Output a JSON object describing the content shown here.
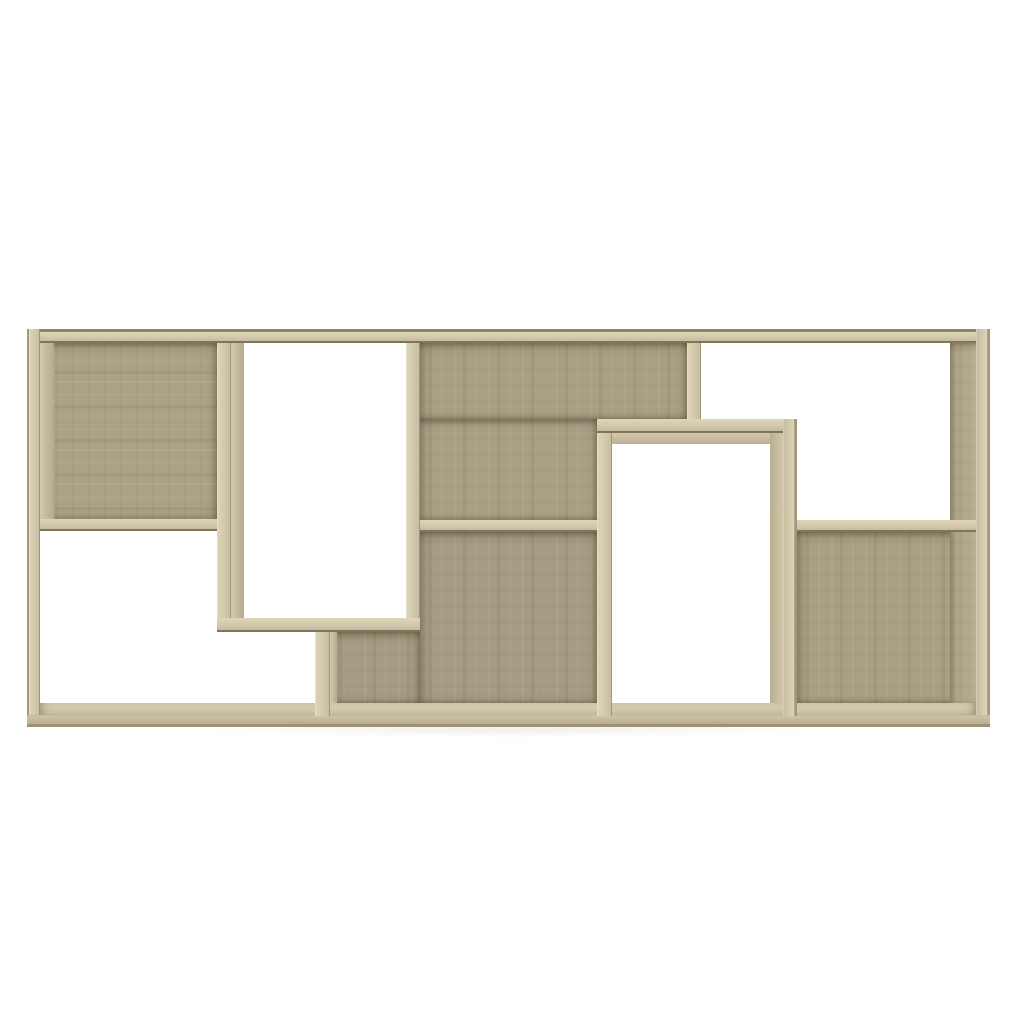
{
  "meta": {
    "description": "Product photo of a geometric cube wall shelf / book cabinet in sonoma oak finish on a plain white background",
    "subject": "bookshelf",
    "finish": "sonoma-oak",
    "background_color": "#ffffff"
  },
  "canvas": {
    "width": 1024,
    "height": 1024
  },
  "palette": {
    "frame": "#d3c9ac",
    "frame_hi": "#ded5b9",
    "frame_lo": "#c5bb9e",
    "edge_dark": "#7f755b",
    "back_a": "#aba186",
    "back_b": "#a99f84",
    "back_c": "#a59c83"
  },
  "shelf": {
    "bounds": {
      "x": 27,
      "y": 329,
      "w": 963,
      "h": 398
    },
    "backs": [
      {
        "name": "back-top-left",
        "x": 40,
        "y": 343,
        "w": 177,
        "h": 176,
        "cls": "back tone-a grain-h"
      },
      {
        "name": "back-top-middle-upper",
        "x": 420,
        "y": 343,
        "w": 267,
        "h": 76,
        "cls": "back tone-b grain-v"
      },
      {
        "name": "back-top-middle-lower",
        "x": 420,
        "y": 419,
        "w": 177,
        "h": 101,
        "cls": "back tone-b grain-v"
      },
      {
        "name": "back-bottom-middle-main",
        "x": 420,
        "y": 532,
        "w": 177,
        "h": 171,
        "cls": "back tone-c grain-v"
      },
      {
        "name": "back-bottom-middle-left",
        "x": 330,
        "y": 632,
        "w": 90,
        "h": 71,
        "cls": "back tone-c grain-v"
      },
      {
        "name": "back-bottom-right",
        "x": 797,
        "y": 532,
        "w": 179,
        "h": 171,
        "cls": "back tone-b grain-v"
      }
    ],
    "floor": [
      {
        "name": "bottom-panel-top-face",
        "x": 40,
        "y": 703,
        "w": 936,
        "h": 12,
        "cls": "floor-face"
      }
    ],
    "inner_faces": [
      {
        "name": "inner-face-left-wall",
        "x": 40,
        "y": 343,
        "w": 14,
        "h": 176,
        "cls": "iface-v"
      },
      {
        "name": "inner-face-right-wall",
        "x": 950,
        "y": 343,
        "w": 26,
        "h": 360,
        "cls": "iface-right grain-v"
      },
      {
        "name": "inner-face-tall-box-left",
        "x": 231,
        "y": 343,
        "w": 13,
        "h": 275,
        "cls": "iface-v"
      },
      {
        "name": "inner-face-right-box-top",
        "x": 612,
        "y": 433,
        "w": 171,
        "h": 11,
        "cls": "iface-h"
      },
      {
        "name": "inner-face-right-box-right",
        "x": 770,
        "y": 433,
        "w": 13,
        "h": 270,
        "cls": "iface-rv"
      },
      {
        "name": "inner-face-divider-bl",
        "x": 330,
        "y": 632,
        "w": 7,
        "h": 71,
        "cls": "iface-v"
      }
    ],
    "compartments": [
      {
        "name": "compartment-top-left-wood",
        "x": 40,
        "y": 343,
        "w": 177,
        "h": 176
      },
      {
        "name": "opening-tall-left-box",
        "x": 231,
        "y": 343,
        "w": 175,
        "h": 275
      },
      {
        "name": "compartment-top-middle-wood",
        "x": 420,
        "y": 343,
        "w": 267,
        "h": 177
      },
      {
        "name": "opening-top-right",
        "x": 701,
        "y": 343,
        "w": 249,
        "h": 177
      },
      {
        "name": "opening-bottom-left",
        "x": 40,
        "y": 531,
        "w": 275,
        "h": 172
      },
      {
        "name": "compartment-bottom-middle-wood",
        "x": 330,
        "y": 532,
        "w": 267,
        "h": 171
      },
      {
        "name": "opening-right-box",
        "x": 612,
        "y": 433,
        "w": 158,
        "h": 270
      },
      {
        "name": "compartment-bottom-right-wood",
        "x": 797,
        "y": 532,
        "w": 179,
        "h": 171
      }
    ],
    "panels": [
      {
        "name": "top-panel",
        "x": 27,
        "y": 329,
        "w": 963,
        "h": 14,
        "cls": "ph ph-top"
      },
      {
        "name": "left-wall",
        "x": 27,
        "y": 329,
        "w": 13,
        "h": 398,
        "cls": "pv pv-left"
      },
      {
        "name": "right-wall",
        "x": 976,
        "y": 329,
        "w": 14,
        "h": 398,
        "cls": "pv pv-right"
      },
      {
        "name": "bottom-front-panel",
        "x": 27,
        "y": 715,
        "w": 963,
        "h": 12,
        "cls": "ph ph-bottom"
      },
      {
        "name": "shelf-top-left",
        "x": 40,
        "y": 519,
        "w": 177,
        "h": 12,
        "cls": "ph"
      },
      {
        "name": "tall-box-left-wall",
        "x": 217,
        "y": 343,
        "w": 14,
        "h": 289,
        "cls": "pv"
      },
      {
        "name": "tall-box-right-wall",
        "x": 406,
        "y": 343,
        "w": 14,
        "h": 289,
        "cls": "pv"
      },
      {
        "name": "tall-box-bottom",
        "x": 217,
        "y": 618,
        "w": 203,
        "h": 14,
        "cls": "ph"
      },
      {
        "name": "divider-bottom-left",
        "x": 315,
        "y": 632,
        "w": 15,
        "h": 84,
        "cls": "pv"
      },
      {
        "name": "shelf-middle",
        "x": 420,
        "y": 520,
        "w": 177,
        "h": 12,
        "cls": "ph"
      },
      {
        "name": "right-box-left-wall",
        "x": 597,
        "y": 419,
        "w": 15,
        "h": 297,
        "cls": "pv"
      },
      {
        "name": "right-box-top",
        "x": 597,
        "y": 419,
        "w": 200,
        "h": 14,
        "cls": "ph"
      },
      {
        "name": "right-box-right-wall",
        "x": 783,
        "y": 419,
        "w": 14,
        "h": 297,
        "cls": "pv-right pv"
      },
      {
        "name": "divider-top-right",
        "x": 687,
        "y": 343,
        "w": 14,
        "h": 76,
        "cls": "pv"
      },
      {
        "name": "shelf-right",
        "x": 797,
        "y": 520,
        "w": 179,
        "h": 12,
        "cls": "ph"
      }
    ],
    "shadows": [
      {
        "name": "unit-floor-shadow",
        "x": 45,
        "y": 727,
        "w": 930,
        "h": 14,
        "cls": "unit-shadow"
      }
    ]
  }
}
